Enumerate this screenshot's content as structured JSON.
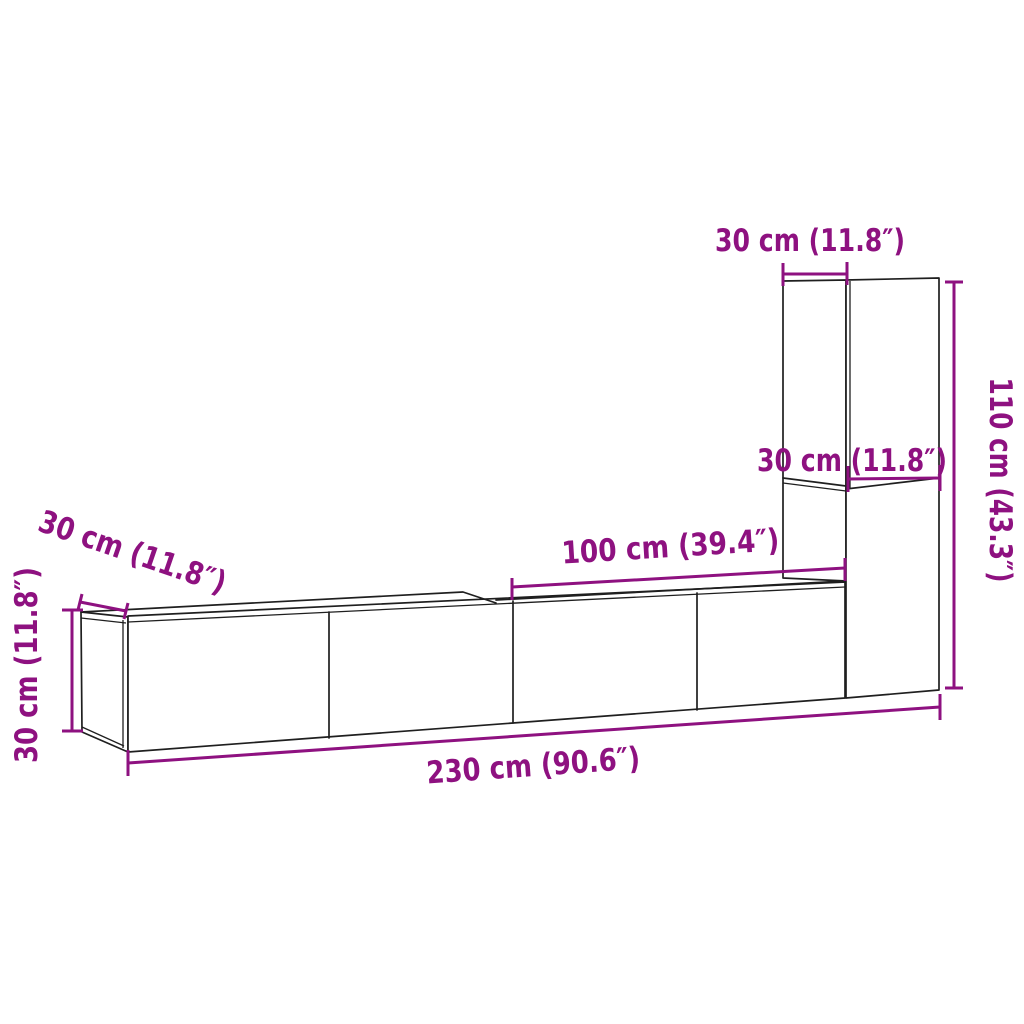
{
  "diagram": {
    "kind": "furniture-dimension-line-drawing",
    "subject": "tv-wall-cabinet-set",
    "colors": {
      "accent": "#8e1180",
      "outline": "#1f1f1f",
      "background": "#ffffff"
    },
    "labels": {
      "tall_cabinet_width": "30 cm (11.8″)",
      "tall_cabinet_depth": "30 cm (11.8″)",
      "tall_cabinet_height": "110 cm (43.3″)",
      "right_unit_width": "100 cm (39.4″)",
      "long_cabinet_depth": "30 cm (11.8″)",
      "long_cabinet_height": "30 cm (11.8″)",
      "total_width": "230 cm (90.6″)"
    }
  }
}
